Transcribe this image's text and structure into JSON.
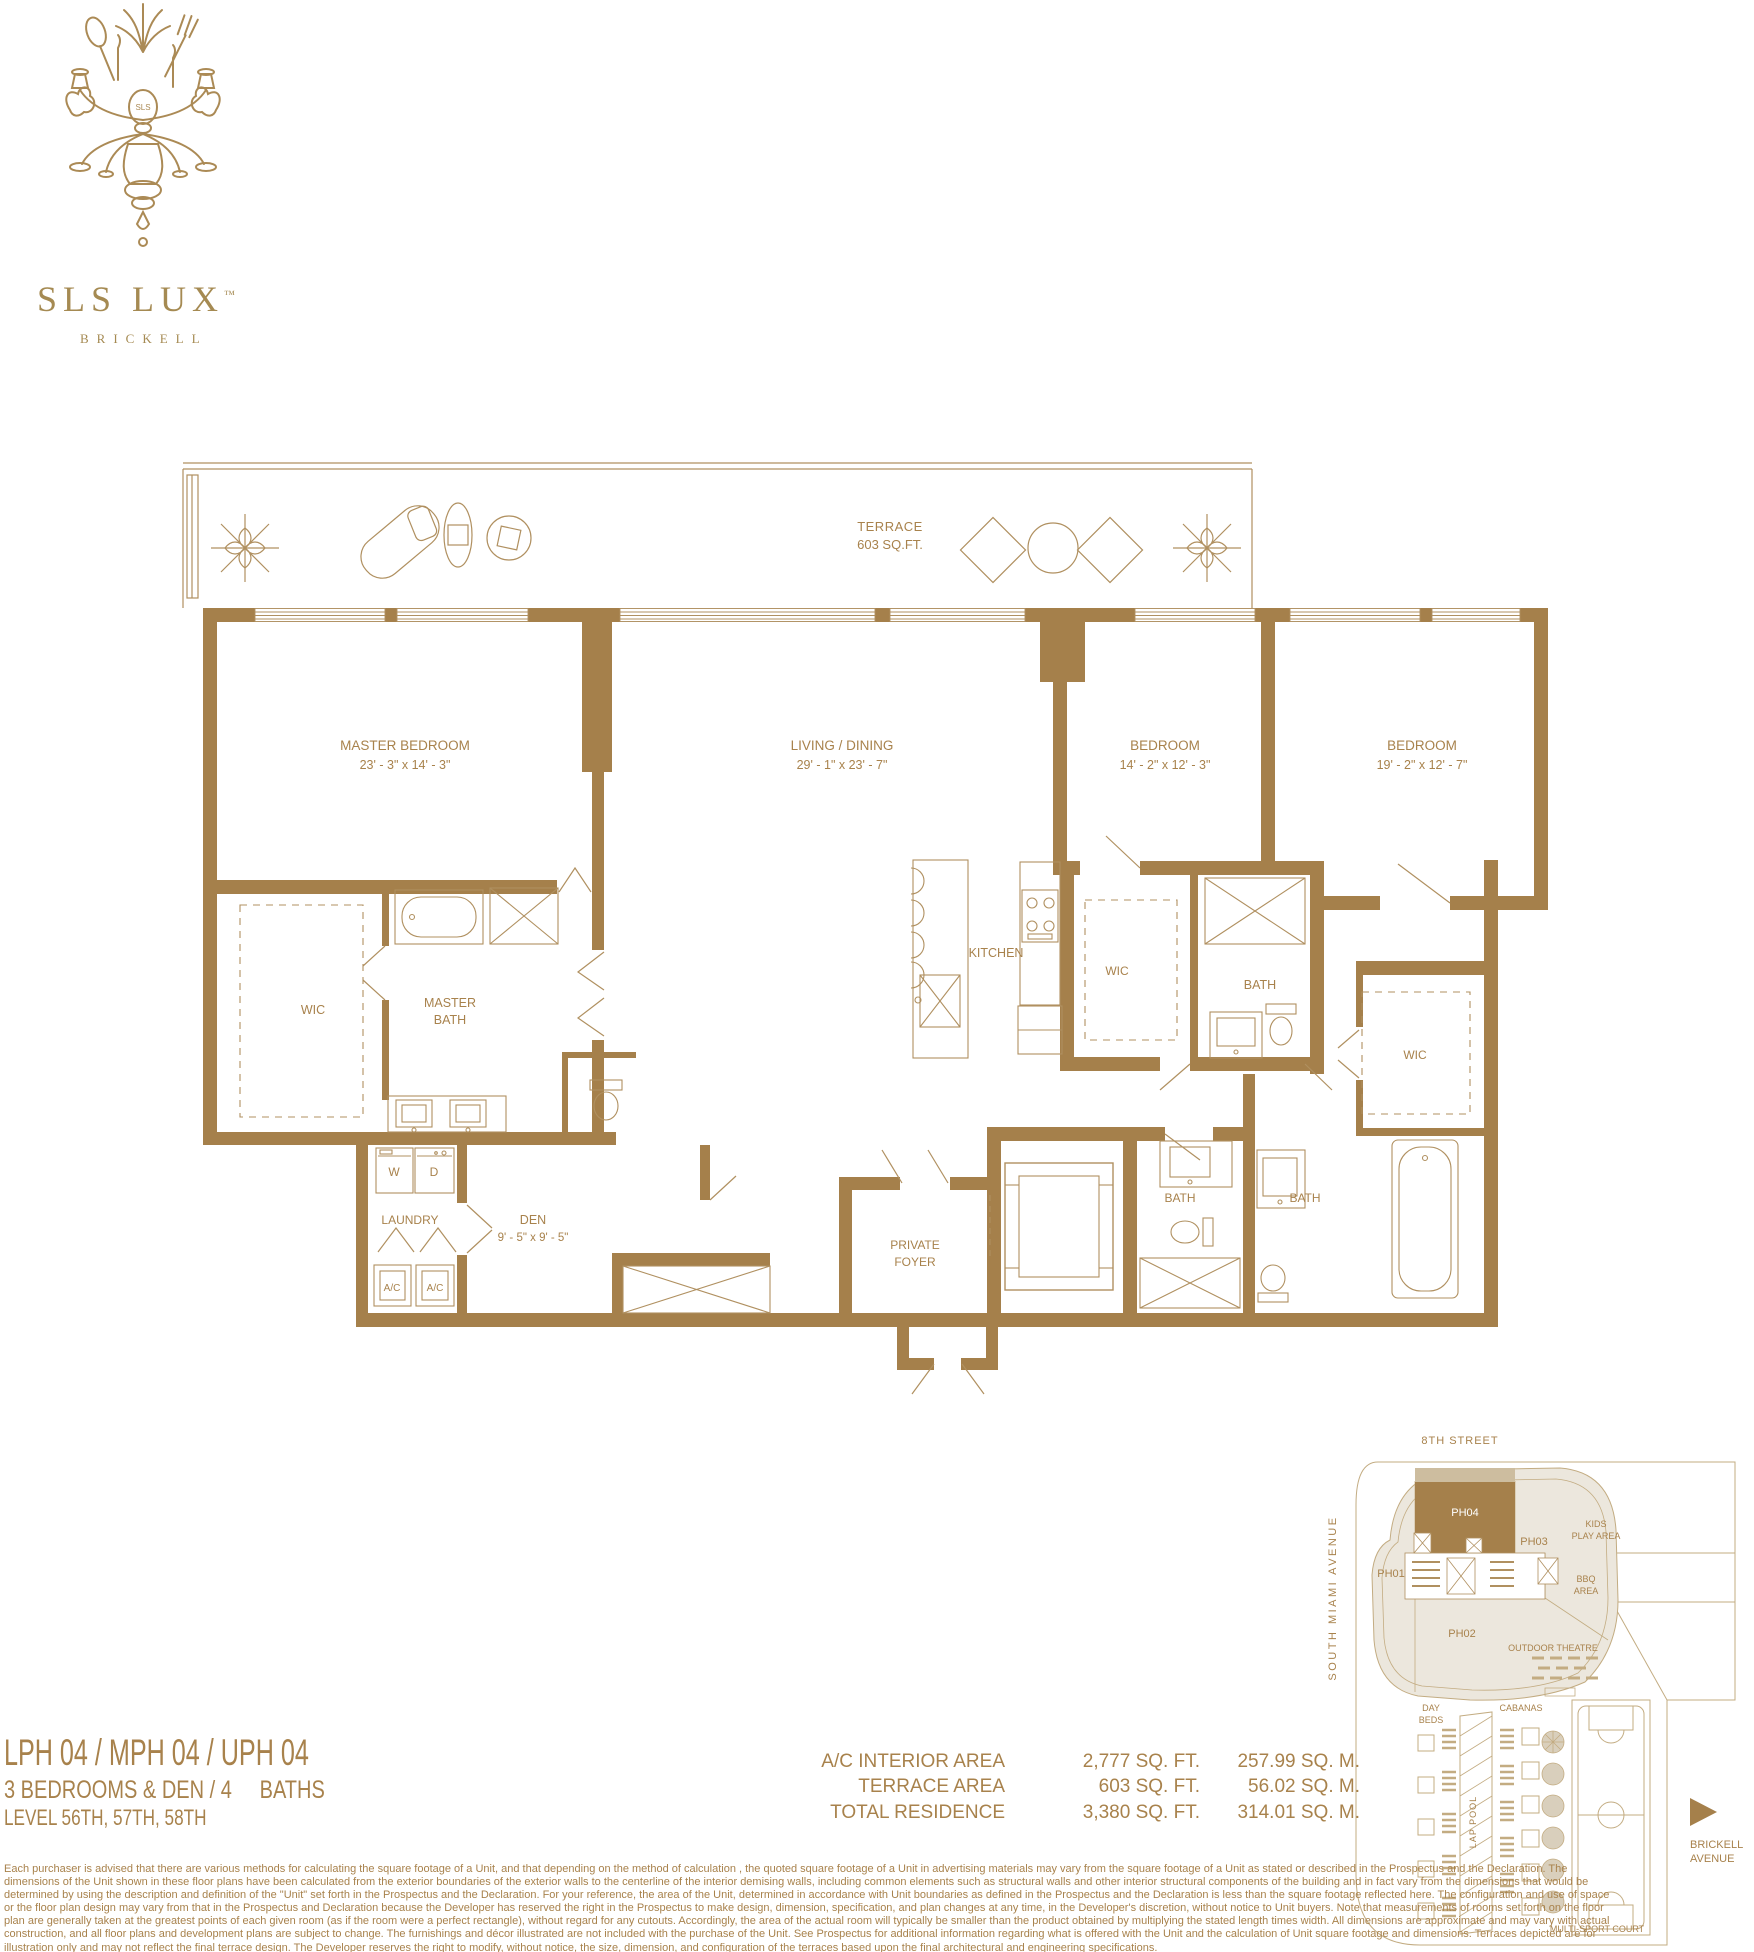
{
  "brand": {
    "name": "SLS LUX",
    "tm": "™",
    "city": "BRICKELL",
    "medallion": "SLS"
  },
  "floorplan": {
    "terrace": {
      "label": "TERRACE",
      "area": "603 SQ.FT."
    },
    "master_bedroom": {
      "name": "MASTER BEDROOM",
      "dims": "23' - 3\" x 14' - 3\""
    },
    "living_dining": {
      "name": "LIVING / DINING",
      "dims": "29' - 1\" x 23' - 7\""
    },
    "bedroom_1": {
      "name": "BEDROOM",
      "dims": "14' - 2\" x 12' - 3\""
    },
    "bedroom_2": {
      "name": "BEDROOM",
      "dims": "19' - 2\" x 12' - 7\""
    },
    "den": {
      "name": "DEN",
      "dims": "9' - 5\" x 9' - 5\""
    },
    "labels": {
      "wic": "WIC",
      "master_bath_1": "MASTER",
      "master_bath_2": "BATH",
      "kitchen": "KITCHEN",
      "bath": "BATH",
      "laundry": "LAUNDRY",
      "foyer_1": "PRIVATE",
      "foyer_2": "FOYER",
      "washer": "W",
      "dryer": "D",
      "ac": "A/C"
    }
  },
  "unit": {
    "title": "LPH 04 / MPH 04 / UPH 04",
    "config": "3 BEDROOMS & DEN / 4     BATHS",
    "level": "LEVEL 56TH, 57TH, 58TH"
  },
  "areas": {
    "rows": [
      {
        "label": "A/C INTERIOR AREA",
        "sqft": "2,777 SQ. FT.",
        "sqm": "257.99 SQ. M."
      },
      {
        "label": "TERRACE AREA",
        "sqft": "603 SQ. FT.",
        "sqm": "56.02 SQ. M."
      },
      {
        "label": "TOTAL RESIDENCE",
        "sqft": "3,380 SQ. FT.",
        "sqm": "314.01 SQ. M."
      }
    ]
  },
  "siteplan": {
    "street_top": "8TH STREET",
    "street_left": "SOUTH MIAMI AVENUE",
    "brickell_1": "BRICKELL",
    "brickell_2": "AVENUE",
    "ph01": "PH01",
    "ph02": "PH02",
    "ph03": "PH03",
    "ph04": "PH04",
    "kids_1": "KIDS",
    "kids_2": "PLAY AREA",
    "bbq_1": "BBQ",
    "bbq_2": "AREA",
    "outdoor_theatre": "OUTDOOR THEATRE",
    "day_1": "DAY",
    "day_2": "BEDS",
    "cabanas": "CABANAS",
    "lap_pool": "LAP POOL",
    "court": "MULTI-SPORT COURT"
  },
  "disclaimer": "Each purchaser is advised that there are various methods for calculating the square footage of a Unit, and that depending on the method of calculation , the quoted square footage of a Unit in advertising materials may vary from the square footage of a Unit as stated or described in the Prospectus and the Declaration.  The dimensions of the Unit shown in these floor plans have been calculated from the exterior boundaries of the exterior walls to the centerline of the interior demising walls, including common elements such as structural walls and other interior structural components of the building and in fact vary from the dimensions that would be determined by using the description and definition of the \"Unit\" set forth in the Prospectus and the Declaration.  For your reference, the area of the Unit, determined in accordance with Unit boundaries as defined in the Prospectus and the Declaration is less than the square footage reflected here. The configuration and use of space or the floor plan design may vary from that in the Prospectus and Declaration because the Developer has reserved the right in the Prospectus to make design, dimension, specification, and plan changes at any time, in the Developer's discretion, without notice to Unit buyers. Note that measurements of rooms set forth on the floor plan are generally taken at the greatest points of each given room (as if the room were a perfect rectangle), without regard for any cutouts.  Accordingly, the area of the actual room will typically be smaller than the product obtained by multiplying the stated length times width.  All dimensions are approximate and may vary with actual construction, and all floor plans and development plans are subject to change.  The furnishings and décor illustrated are not included with the purchase of the Unit. See Prospectus for additional information regarding what is offered with the Unit and the calculation of Unit square footage and dimensions.  Terraces depicted are for illustration only and may not reflect the final terrace design. The Developer reserves the right to modify, without notice, the size, dimension, and configuration of the terraces based upon the final architectural and engineering specifications.",
  "colors": {
    "gold_text": "#a8824c",
    "wall": "#a5804b",
    "line": "#b09060",
    "site_beige": "#ece7dd"
  }
}
